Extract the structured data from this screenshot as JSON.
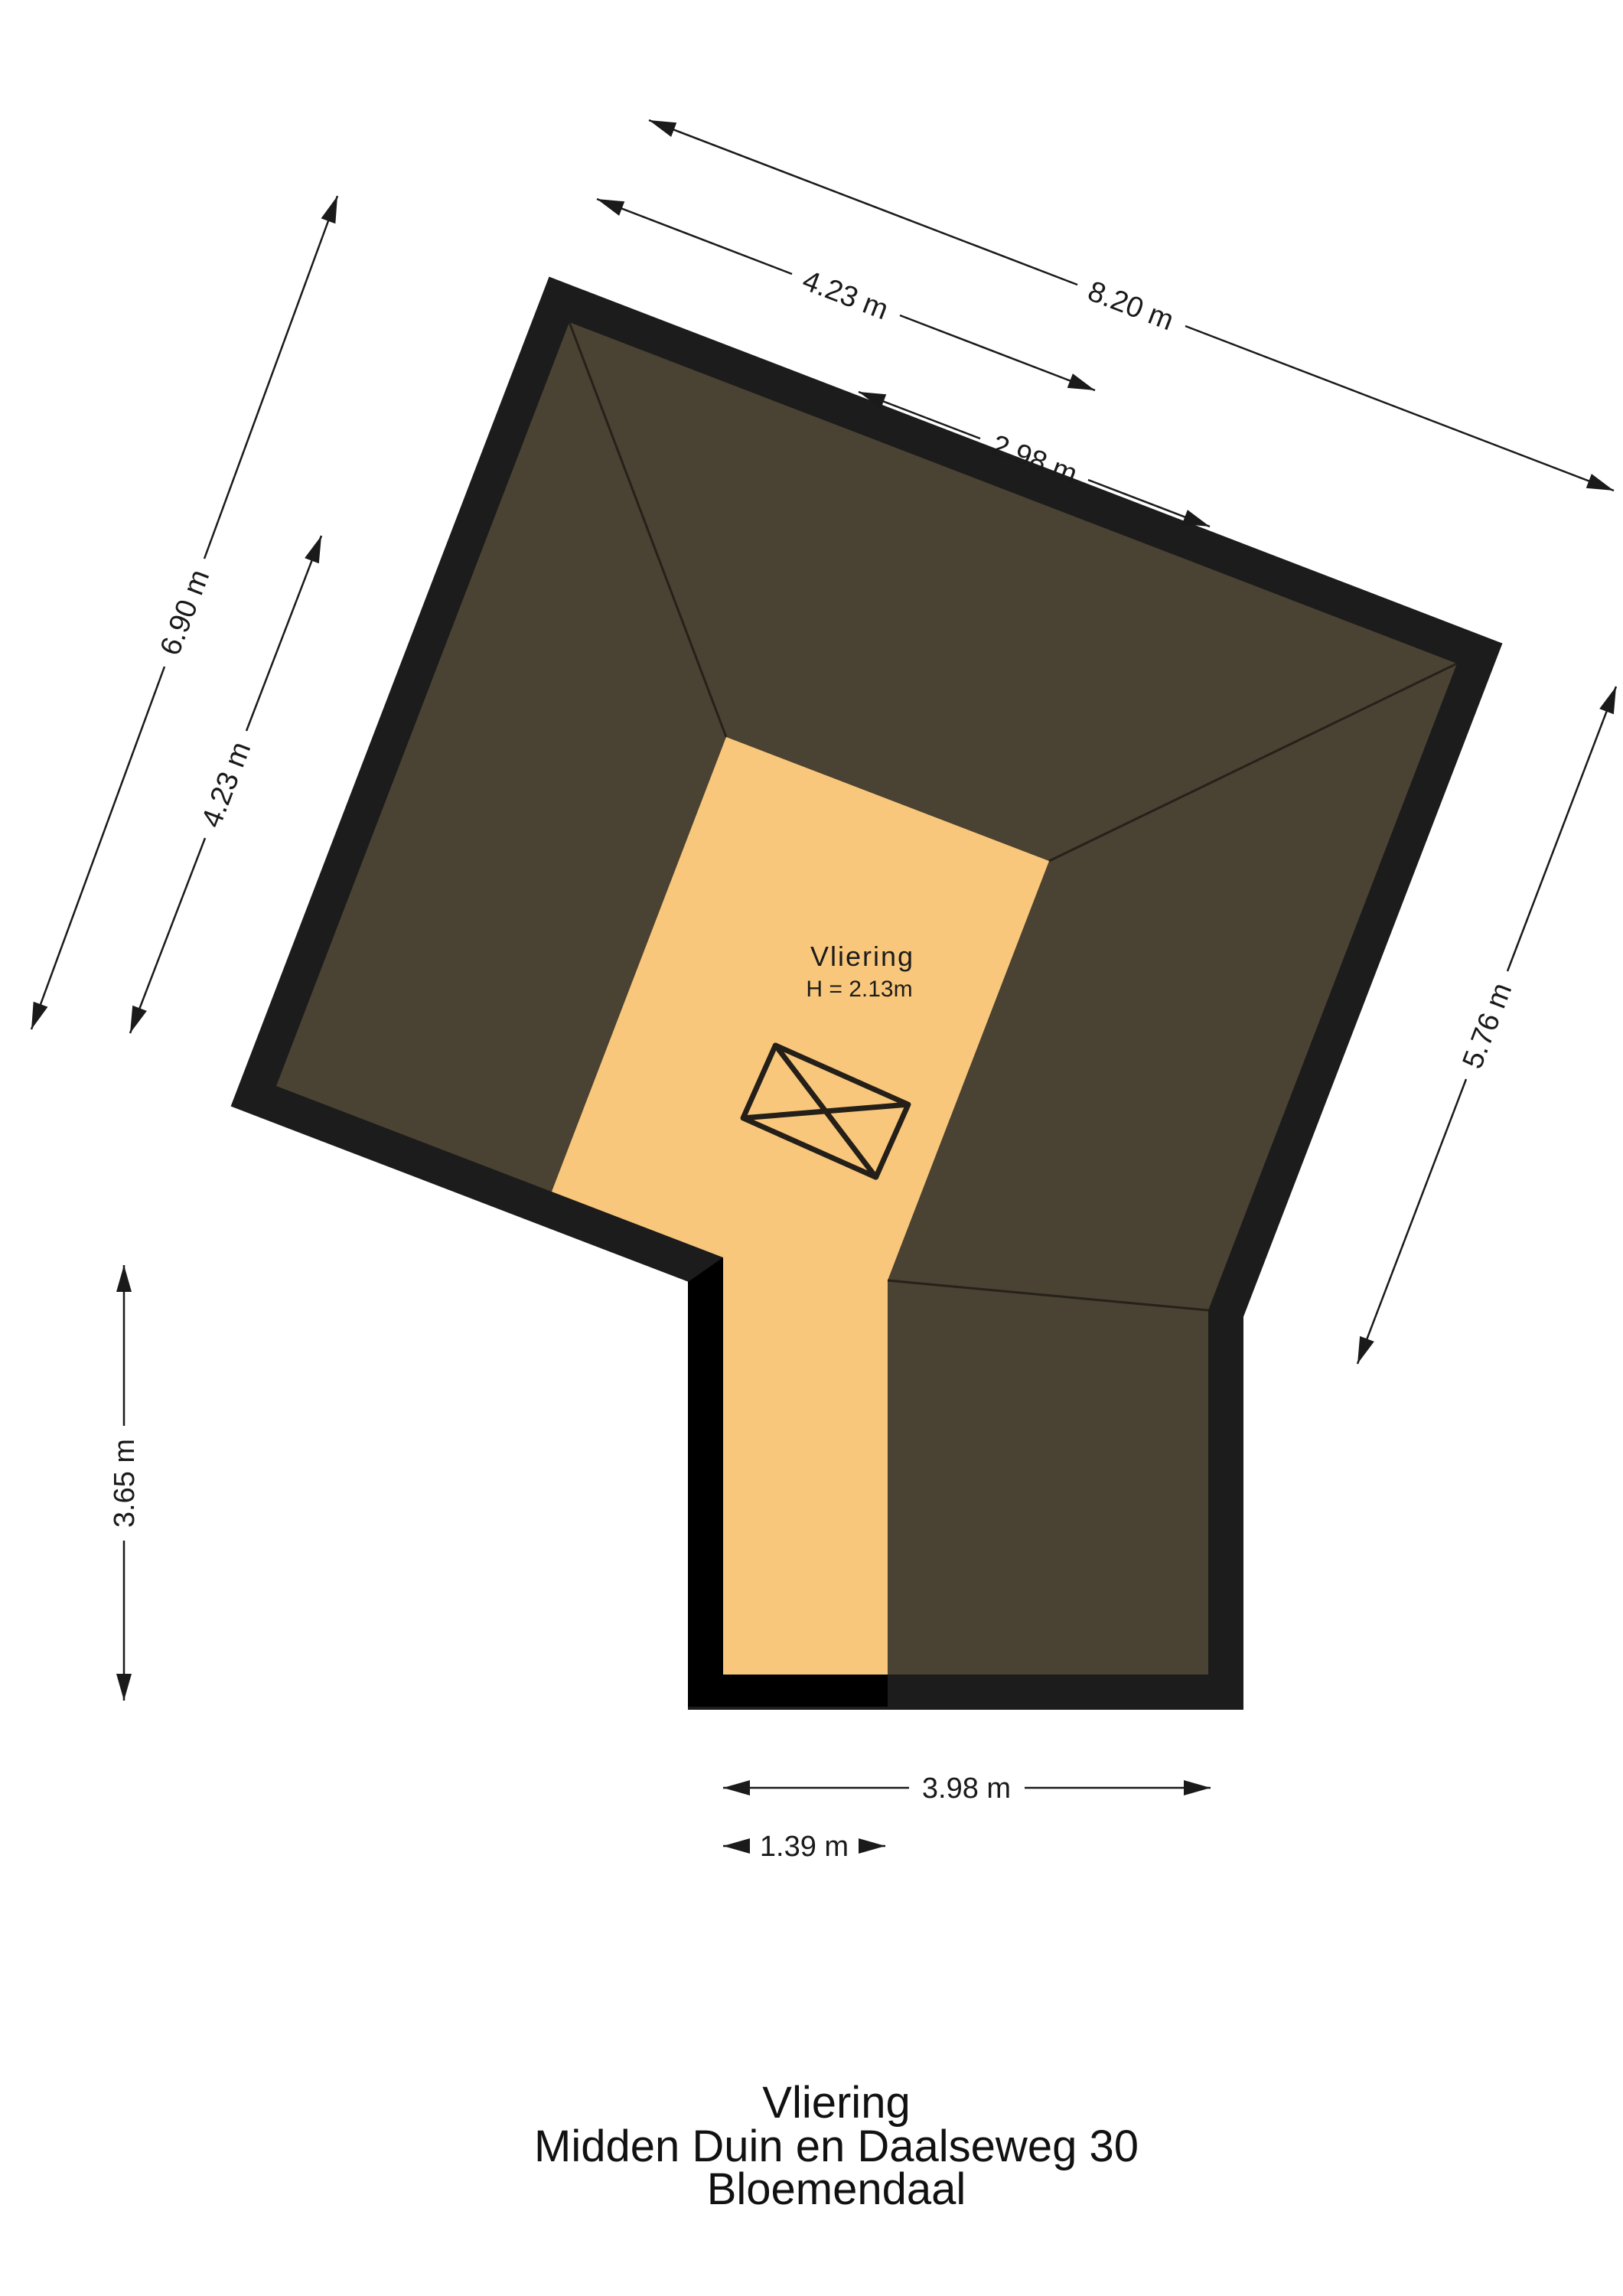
{
  "room_label": {
    "name": "Vliering",
    "height": "H = 2.13m"
  },
  "title_block": {
    "room": "Vliering",
    "address": "Midden Duin en Daalseweg 30",
    "city": "Bloemendaal"
  },
  "dimensions": {
    "top_outer": "8.20 m",
    "top_left_segment": "4.23 m",
    "top_inner": "2.98 m",
    "left_outer": "6.90 m",
    "left_inner": "4.23 m",
    "right_side": "5.76 m",
    "extension_height": "3.65 m",
    "extension_bottom": "3.98 m",
    "corridor_bottom": "1.39 m"
  },
  "colors": {
    "roof": "#4a4232",
    "floor": "#f9c77b",
    "wall": "#1c1c1c",
    "wall_accent": "#000000",
    "dimension_line": "#1a1a1a",
    "background": "#ffffff"
  }
}
